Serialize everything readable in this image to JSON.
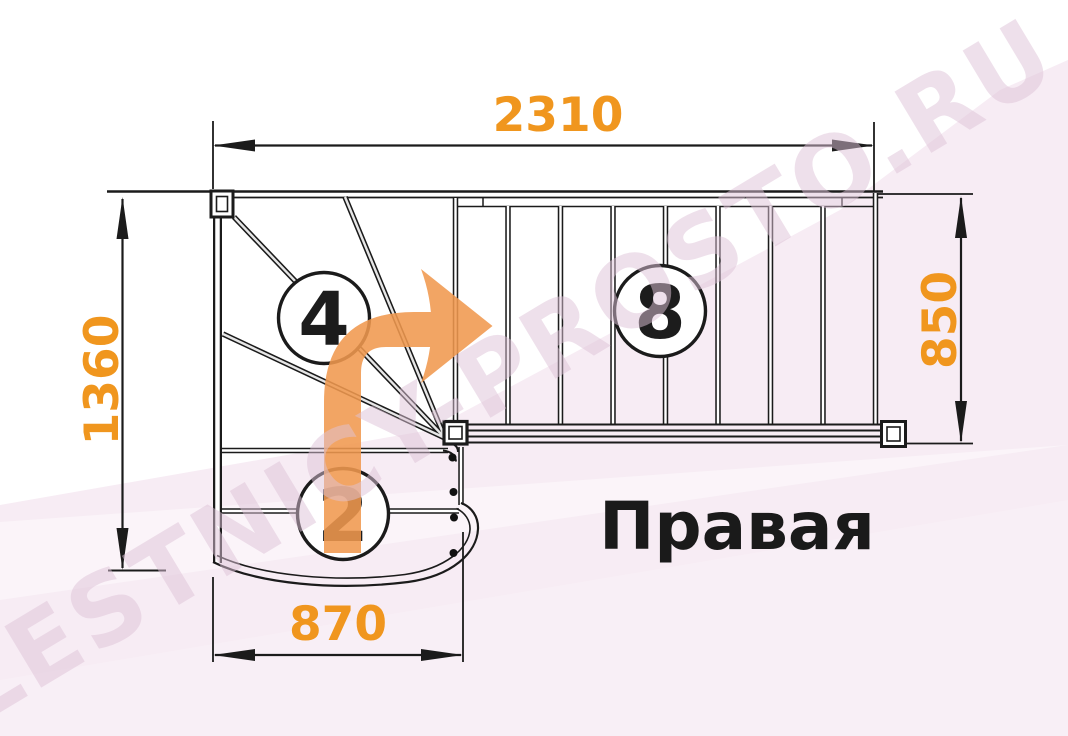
{
  "diagram": {
    "label": "Правая",
    "watermark": "LESTNICY-PROSTO.RU",
    "dimensions": {
      "top": "2310",
      "left": "1360",
      "right": "850",
      "bottom": "870"
    },
    "steps": {
      "winder_count": "4",
      "lower_flight_count": "2",
      "upper_flight_count": "8"
    }
  },
  "colors": {
    "dimension_text": "#F0961E",
    "arrow": "#F0994E",
    "background_pink": "#F7ECF4",
    "watermark": "#DFC3D8",
    "line": "#1B1B1B"
  }
}
